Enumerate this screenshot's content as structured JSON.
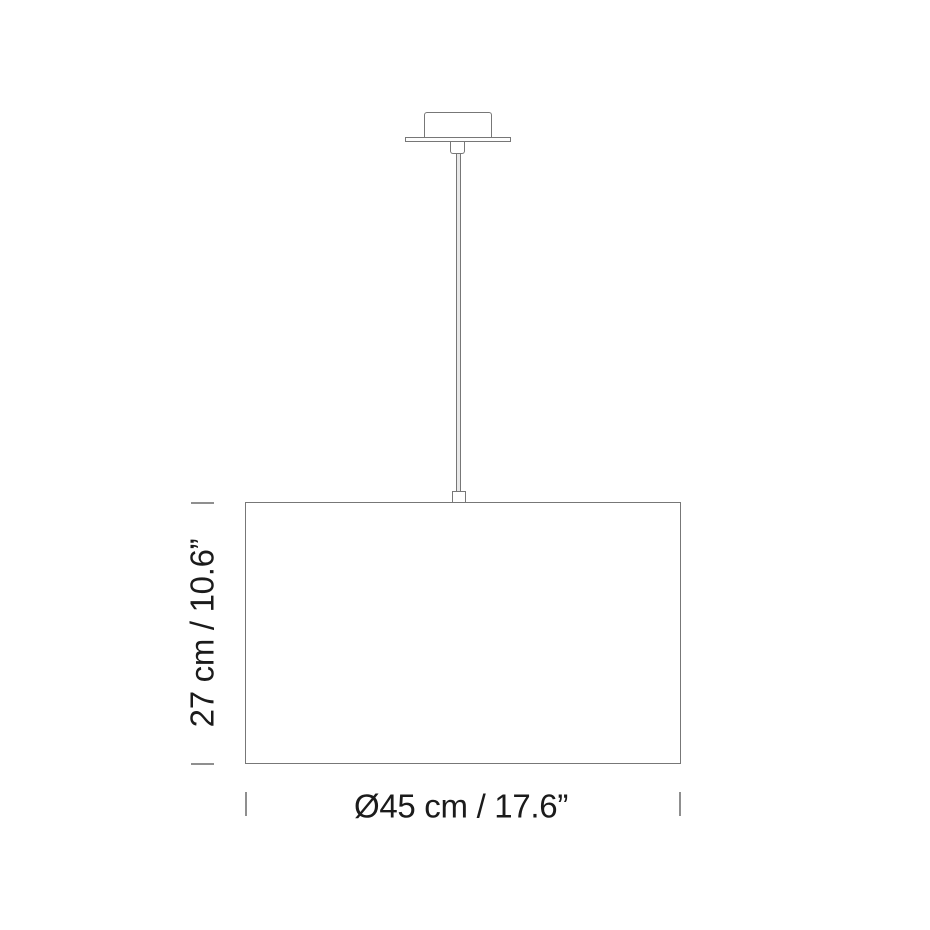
{
  "diagram": {
    "type": "pendant-lamp-dimension-drawing",
    "labels": {
      "height": "27 cm / 10.6”",
      "diameter": "Ø45 cm / 17.6”"
    },
    "colors": {
      "line": "#777777",
      "tick": "#8f8f8f",
      "text": "#1b1b1b",
      "rod_fill": "#e9e9e9",
      "background": "#ffffff"
    }
  }
}
